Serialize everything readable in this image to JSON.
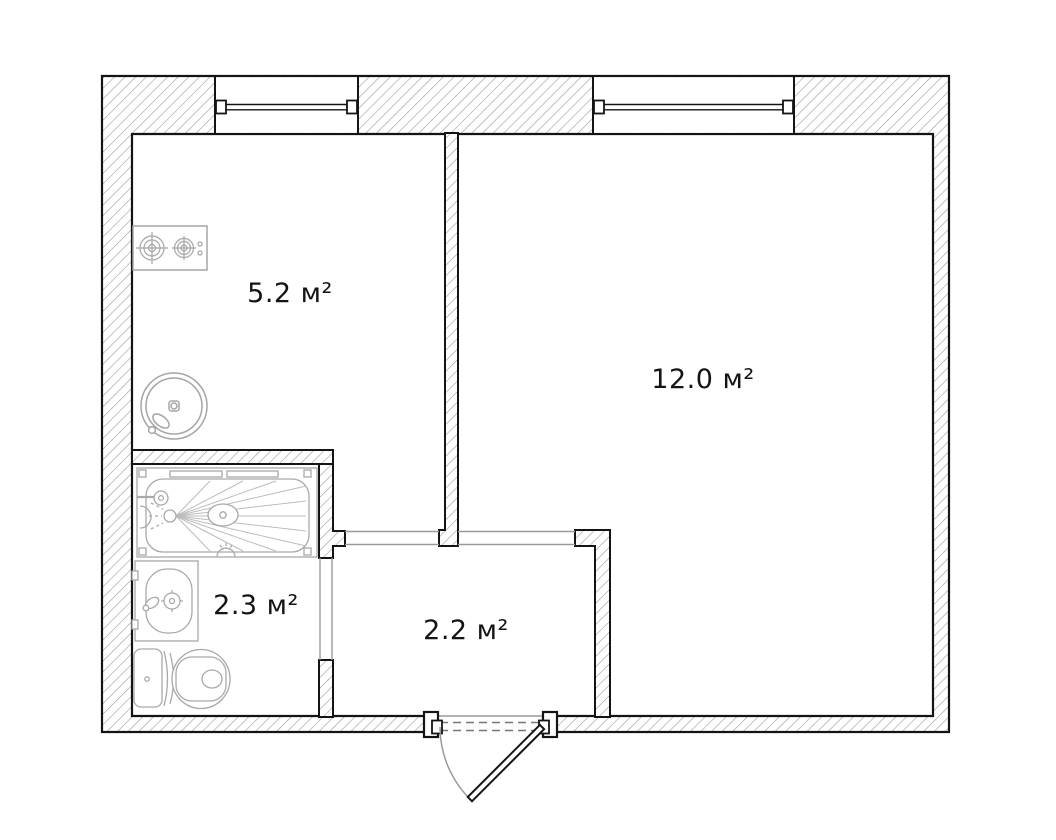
{
  "floor_plan": {
    "type": "apartment-floor-plan",
    "rooms": [
      {
        "id": "kitchen",
        "area_label": "5.2 м²"
      },
      {
        "id": "living-room",
        "area_label": "12.0 м²"
      },
      {
        "id": "bathroom",
        "area_label": "2.3 м²"
      },
      {
        "id": "hallway",
        "area_label": "2.2 м²"
      }
    ],
    "fixtures": [
      {
        "id": "stove",
        "room": "kitchen"
      },
      {
        "id": "kitchen-sink",
        "room": "kitchen"
      },
      {
        "id": "bathtub",
        "room": "bathroom"
      },
      {
        "id": "washbasin",
        "room": "bathroom"
      },
      {
        "id": "toilet",
        "room": "bathroom"
      }
    ],
    "openings": [
      {
        "id": "window-1",
        "wall": "top"
      },
      {
        "id": "window-2",
        "wall": "top"
      },
      {
        "id": "entrance-door",
        "wall": "bottom",
        "swing": "outward"
      },
      {
        "id": "bathroom-door-opening",
        "wall": "bathroom-right"
      },
      {
        "id": "kitchen-hallway-passage",
        "wall": "hallway-top"
      },
      {
        "id": "room-hallway-passage",
        "wall": "hallway-top"
      }
    ],
    "colors": {
      "background": "#ffffff",
      "wall_outline": "#141414",
      "wall_hatch": "#9c9c9c",
      "fixture_line": "#a5a5a5",
      "passage_line": "#999999",
      "label_text": "#141414"
    }
  }
}
